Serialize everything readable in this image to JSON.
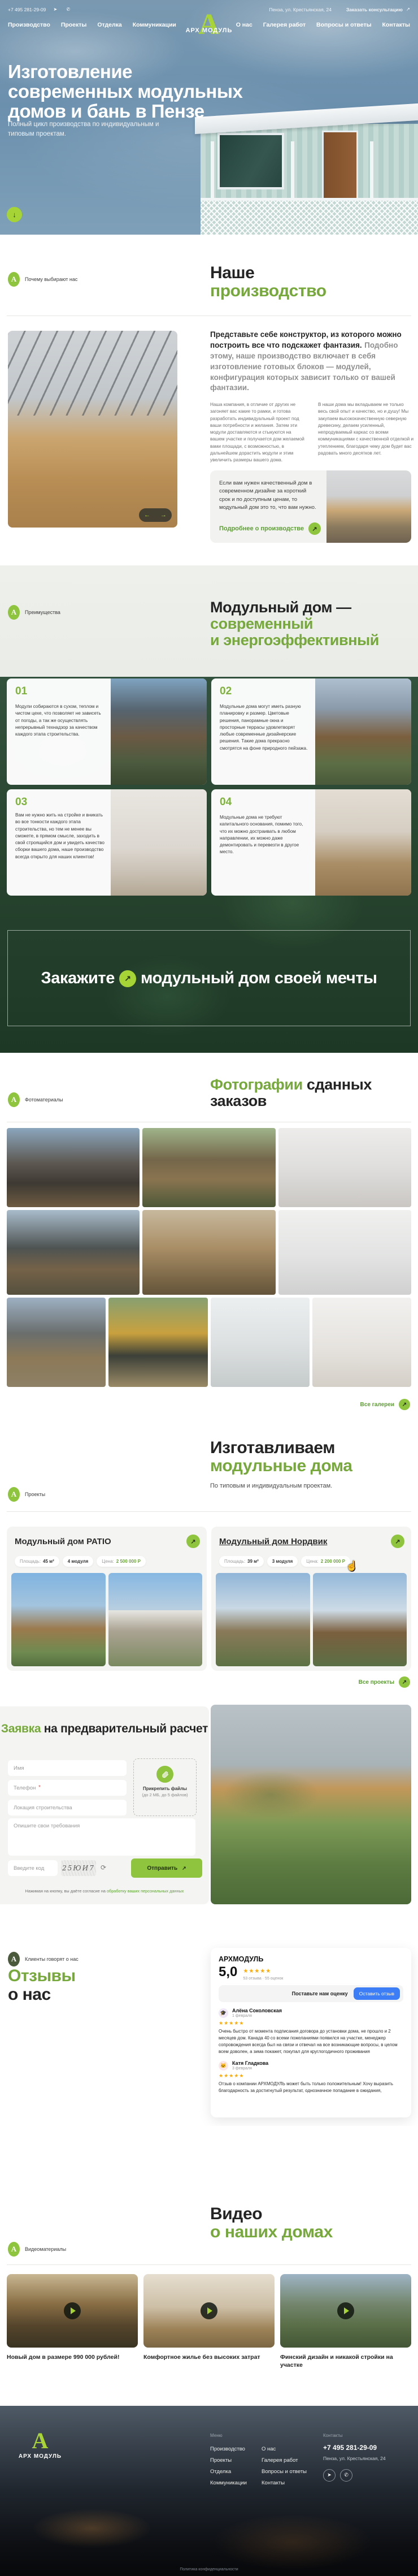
{
  "brand": {
    "name": "АРХ МОДУЛЬ",
    "letter": "А"
  },
  "colors": {
    "accent": "#8fc43e",
    "heading_green": "#76a83c",
    "dark_text": "#242424",
    "star": "#ffaa00",
    "review_button_blue": "#3d7df6"
  },
  "icons": {
    "arrow_up_right": "↗",
    "arrow_down": "↓",
    "arrow_left": "←",
    "arrow_right": "→",
    "telegram": "➤",
    "whatsapp": "✆",
    "refresh": "⟳"
  },
  "header": {
    "phone": "+7 495 281-29-09",
    "address": "Пенза, ул. Крестьянская, 24",
    "consult": "Заказать консультацию",
    "nav_left": [
      "Производство",
      "Проекты",
      "Отделка",
      "Коммуникации"
    ],
    "nav_right": [
      "О нас",
      "Галерея работ",
      "Вопросы и ответы",
      "Контакты"
    ]
  },
  "hero": {
    "title": "Изготовление современных модульных домов и бань в Пензе",
    "subtitle": "Полный цикл производства по индивидуальным и типовым проектам."
  },
  "production": {
    "badge": "Почему выбирают нас",
    "heading_dark": "Наше",
    "heading_green": "производство",
    "lead_bold": "Представьте себе конструктор, из которого можно построить все что подскажет фантазия.",
    "lead_gray": "Подобно этому, наше производство включает в себя изготовление готовых блоков — модулей, конфигурация которых зависит только от вашей фантазии.",
    "col1": "Наша компания, в отличие от других не загоняет вас какие то рамки, и готова разработать индивидуальный проект под ваши потребности и желания. Затем эти модули доставляются и стыкуются на вашем участке и получается дом желаемой вами площади, с возможностью, в дальнейшем дорастить модули и этим увеличить размеры вашего дома.",
    "col2": "В наши дома мы вкладываем не только весь свой опыт и качество, но и душу! Мы закупаем высококачественную северную древесину, делаем усиленный, непродуваемый каркас со всеми коммуникациями с качественной отделкой и утеплением, благодаря чему дом будет вас радовать много десятков лет.",
    "card_text": "Если вам нужен качественный дом в современном дизайне за короткий срок и по доступным ценам, то модульный дом это то, что вам нужно.",
    "card_link": "Подробнее о производстве"
  },
  "advantages": {
    "badge": "Преимущества",
    "heading_dark": "Модульный дом —",
    "heading_green_1": "современный",
    "heading_green_2": "и энергоэффективный",
    "items": [
      {
        "num": "01",
        "text": "Модули собираются в сухом, теплом и чистом цехе, что позволяет не зависеть от погоды, а так же осуществлять непрерывный технадзор за качеством каждого этапа строительства."
      },
      {
        "num": "02",
        "text": "Модульные дома могут иметь разную планировку и размер. Цветовые решения, панорамные окна и просторные террасы удовлетворят любые современные дизайнерские решения. Такие дома прекрасно смотрятся на фоне природного пейзажа."
      },
      {
        "num": "03",
        "text": "Вам не нужно жить на стройке и вникать во все тонкости каждого этапа строительства, но тем не менее вы сможете, в прямом смысле, заходить в свой строящийся дом и увидеть качество сборки вашего дома, наше производство всегда открыто для наших клиентов!"
      },
      {
        "num": "04",
        "text": "Модульные дома не требуют капитального основания, помимо того, что их можно достраивать в любом направлении, их можно даже демонтировать и перевезти в другое место."
      }
    ],
    "cta_part1": "Закажите",
    "cta_part2": "модульный дом своей мечты"
  },
  "gallery": {
    "badge": "Фотоматериалы",
    "heading_green": "Фотографии",
    "heading_dark": "сданных заказов",
    "link": "Все галереи"
  },
  "projects": {
    "badge": "Проекты",
    "heading_dark": "Изготавливаем",
    "heading_green": "модульные дома",
    "subtitle": "По типовым и индивидуальным проектам.",
    "cards": [
      {
        "title": "Модульный дом PATIO",
        "area_label": "Площадь:",
        "area": "45 м²",
        "modules": "4 модуля",
        "price_label": "Цена:",
        "price": "2 500 000 Р"
      },
      {
        "title": "Модульный дом Нордвик",
        "area_label": "Площадь:",
        "area": "39 м²",
        "modules": "3 модуля",
        "price_label": "Цена:",
        "price": "2 200 000 Р"
      }
    ],
    "link": "Все проекты"
  },
  "request_form": {
    "heading_green": "Заявка",
    "heading_dark": "на предварительный расчет",
    "name_placeholder": "Имя",
    "phone_placeholder": "Телефон",
    "required_mark": "*",
    "location_placeholder": "Локация строительства",
    "requirements_placeholder": "Опишите свои требования",
    "captcha_placeholder": "Введите код",
    "captcha_code": "25ЮИ7",
    "attach_title": "Прикрепить файлы",
    "attach_note": "(до 2 МБ, до 5 файлов)",
    "submit": "Отправить",
    "consent_prefix": "Нажимая на кнопку, вы даёте согласие на",
    "consent_link": "обработку ваших персональных данных"
  },
  "reviews": {
    "badge": "Клиенты говорят о нас",
    "heading_green": "Отзывы",
    "heading_dark": "о нас",
    "widget": {
      "org": "АРХМОДУЛЬ",
      "rating": "5,0",
      "stars": "★★★★★",
      "count": "53 отзыва · 55 оценок",
      "prompt": "Поставьте нам оценку",
      "button": "Оставить отзыв",
      "items": [
        {
          "name": "Алёна Соколовская",
          "date": "1 февраля",
          "stars": "★★★★★",
          "avatar": "🎓",
          "text": "Очень быстро от момента подписания договора до установки дома, не прошло и 2 месяцев дом. Канада 40 со всеми пожеланиями появился на участке, менеджер сопровождения всегда был на связи и отвечал на все возникающие вопросы, в целом всем доволен, а зима покажет, покупал для круглогодичного проживания"
        },
        {
          "name": "Катя Гладкова",
          "date": "3 февраля",
          "stars": "★★★★★",
          "avatar": "🐱",
          "text": "Отзыв о компании АРХМОДУЛЬ может быть только положительным! Хочу выразить благодарность за достигнутый результат, однозначное попадание в ожидания,"
        }
      ]
    }
  },
  "videos": {
    "badge": "Видеоматериалы",
    "heading_dark": "Видео",
    "heading_green": "о наших домах",
    "items": [
      {
        "title": "Новый дом в размере 990 000 рублей!"
      },
      {
        "title": "Комфортное жилье без высоких затрат"
      },
      {
        "title": "Финский дизайн и никакой стройки на участке"
      }
    ]
  },
  "footer": {
    "menu_title": "Меню",
    "menu_col1": [
      "Производство",
      "Проекты",
      "Отделка",
      "Коммуникации"
    ],
    "menu_col2": [
      "О нас",
      "Галерея работ",
      "Вопросы и ответы",
      "Контакты"
    ],
    "contacts_title": "Контакты",
    "phone": "+7 495 281-29-09",
    "address": "Пенза, ул. Крестьянская, 24",
    "policy": "Политика конфиденциальности"
  }
}
